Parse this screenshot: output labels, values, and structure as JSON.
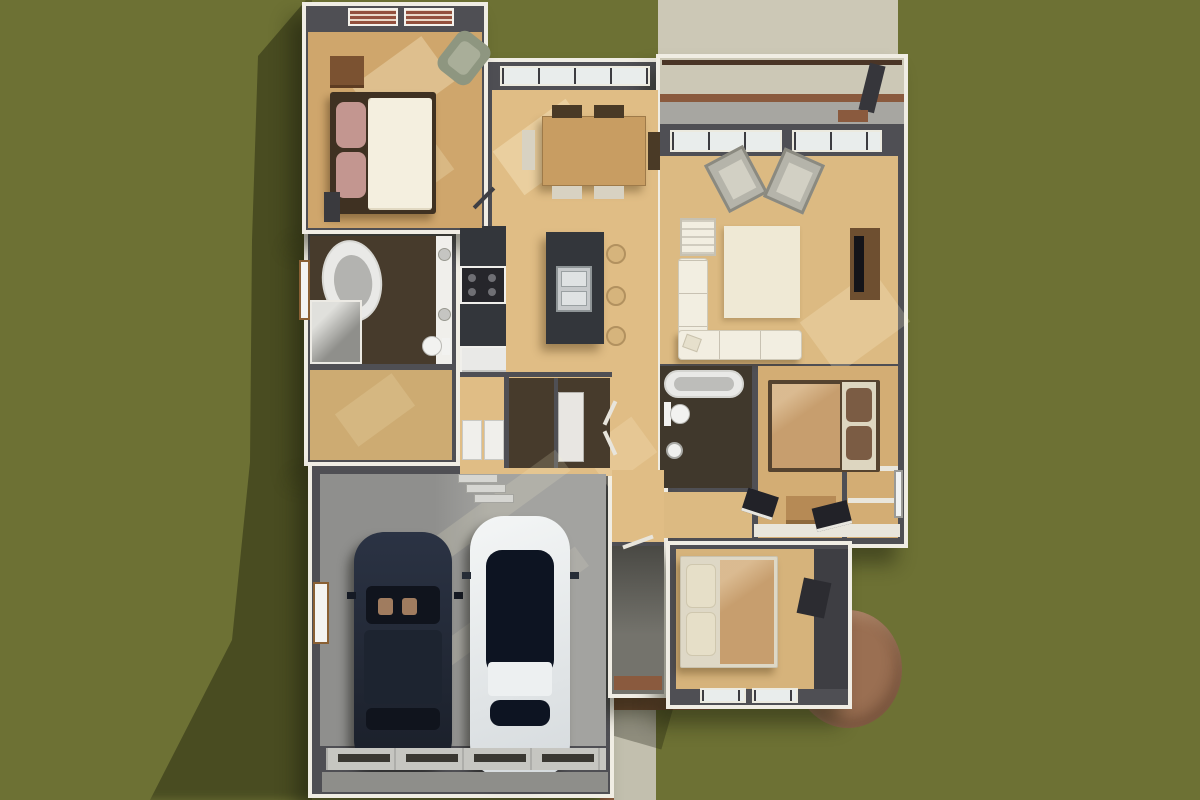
{
  "scene": {
    "title": "Aerial top-down 3D rendering of a single-story house floor plan on a grass lawn",
    "view": "top-down dollhouse cutaway",
    "lighting": "sunlight from upper-right, shadows cast to lower-left",
    "rooms": [
      {
        "name": "master-bedroom",
        "items": [
          "double bed with white duvet and mauve pillows",
          "dark headboard frame",
          "nightstand",
          "green armchair",
          "dresser",
          "two louvered windows"
        ]
      },
      {
        "name": "master-bathroom",
        "items": [
          "oval bathtub",
          "double-sink vanity",
          "toilet",
          "corner shower",
          "dark tile floor",
          "side window"
        ]
      },
      {
        "name": "walk-in-closet",
        "items": []
      },
      {
        "name": "laundry-mudroom",
        "items": [
          "washer",
          "dryer",
          "storage closet",
          "bifold doors",
          "dark tile floor"
        ]
      },
      {
        "name": "kitchen",
        "items": [
          "wall counter with stove and fridge",
          "dark marble island with stainless double sink",
          "three bar stools"
        ]
      },
      {
        "name": "dining-area",
        "items": [
          "wood dining table",
          "two dark chairs",
          "two light chairs",
          "bench",
          "window wall"
        ]
      },
      {
        "name": "living-room",
        "items": [
          "cream sectional sofa",
          "cream armchair",
          "area rug",
          "two gray accent chairs",
          "tv console with tv",
          "window wall"
        ]
      },
      {
        "name": "hall-bathroom",
        "items": [
          "bathtub",
          "toilet",
          "round sink",
          "dark tile floor"
        ]
      },
      {
        "name": "bedroom-2",
        "items": [
          "bed with tan duvet and brown pillows",
          "wood dresser",
          "desk with open books",
          "closet shelves",
          "east window"
        ]
      },
      {
        "name": "bedroom-3",
        "items": [
          "bed with tan duvet and cream pillows",
          "desk chair",
          "double window on south wall"
        ]
      },
      {
        "name": "entry-foyer",
        "items": [
          "wood foyer",
          "covered stoop with brick trim"
        ]
      },
      {
        "name": "garage",
        "items": [
          "dark navy SUV",
          "white sedan",
          "segmented garage door",
          "entry steps",
          "side window"
        ]
      }
    ],
    "outdoor": [
      "paver walkway at top leading to covered porch",
      "covered porch with paver and concrete floor, wood beam and corner post",
      "front entry walkway with brick edging",
      "semicircular brick patio at rear corner",
      "grass lawn with cast house shadow"
    ],
    "vehicles": [
      {
        "name": "suv",
        "color_name": "dark navy"
      },
      {
        "name": "sedan",
        "color_name": "white with dark glass roof"
      }
    ]
  },
  "palette": {
    "grass": "#6d7134",
    "castShadow": "rgba(28,32,12,0.45)",
    "paver": "#ccc8b6",
    "paverFront": "#c2bfae",
    "brick": "#8a5a3e",
    "patioBrick": "#9a6f52",
    "wall": "#4f4f54",
    "fascia": "#f0ede4",
    "woodBedroom": "#cfa66c",
    "woodMain": "#e0bd85",
    "woodLiving": "#dcba82",
    "woodBed2": "#d3ad74",
    "woodBed3": "#d6b37b",
    "woodCloset": "#cdab72",
    "tileDark": "#473b2c",
    "tileBath2": "#40382c",
    "garageFloor": "#9c9c99",
    "stoopTile": "#74736c",
    "concretePorch": "#a7a6a1",
    "marble": "#33363b",
    "stool": "#d6b47c",
    "carDark": "#242b38",
    "carWhite": "#eef1f2",
    "sofa": "#f2eee1",
    "rug": "#efe9d5",
    "bedWhiteDuvet": "#f4efdf",
    "pillowMauve": "#c39690",
    "duvetTan": "#c79e6e",
    "pillowBrown": "#7b5c44",
    "chairGray": "#b5b4aa",
    "chairGreen": "#8e9680",
    "tub": "#e9e9e7",
    "appliance": "#f0efeb",
    "table": "#c89d62",
    "garageDoor": "#c6c6c1"
  }
}
